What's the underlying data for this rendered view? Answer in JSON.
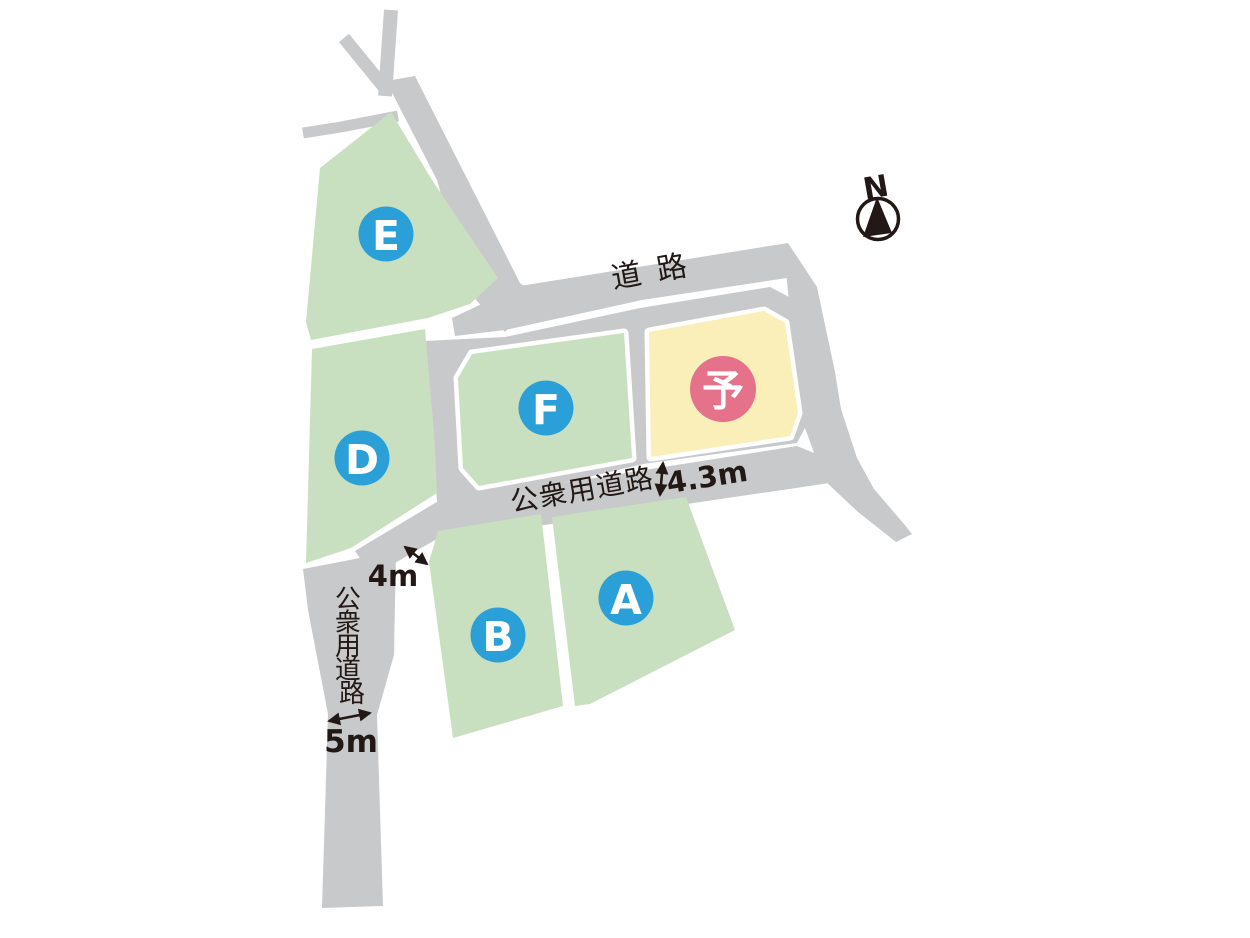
{
  "colors": {
    "road": "#c8c9ca",
    "plot_green": "#c8e0bf",
    "plot_yellow": "#faeeb9",
    "circle_blue": "#2a9fd8",
    "circle_pink": "#e5718a",
    "ink": "#221815"
  },
  "plots": [
    {
      "id": "E",
      "label": "E",
      "status": "available"
    },
    {
      "id": "D",
      "label": "D",
      "status": "available"
    },
    {
      "id": "F",
      "label": "F",
      "status": "available"
    },
    {
      "id": "B",
      "label": "B",
      "status": "available"
    },
    {
      "id": "A",
      "label": "A",
      "status": "available"
    },
    {
      "id": "reserved",
      "label": "予",
      "status": "reserved"
    }
  ],
  "roads": {
    "top_road": "道路",
    "public_road_horizontal": "公衆用道路",
    "public_road_vertical_chars": [
      "公",
      "衆",
      "用",
      "道",
      "路"
    ]
  },
  "dimensions": {
    "loop_road_width": "4.3m",
    "branch_road_width": "4m",
    "south_road_width": "5m"
  },
  "compass": {
    "label": "N"
  }
}
